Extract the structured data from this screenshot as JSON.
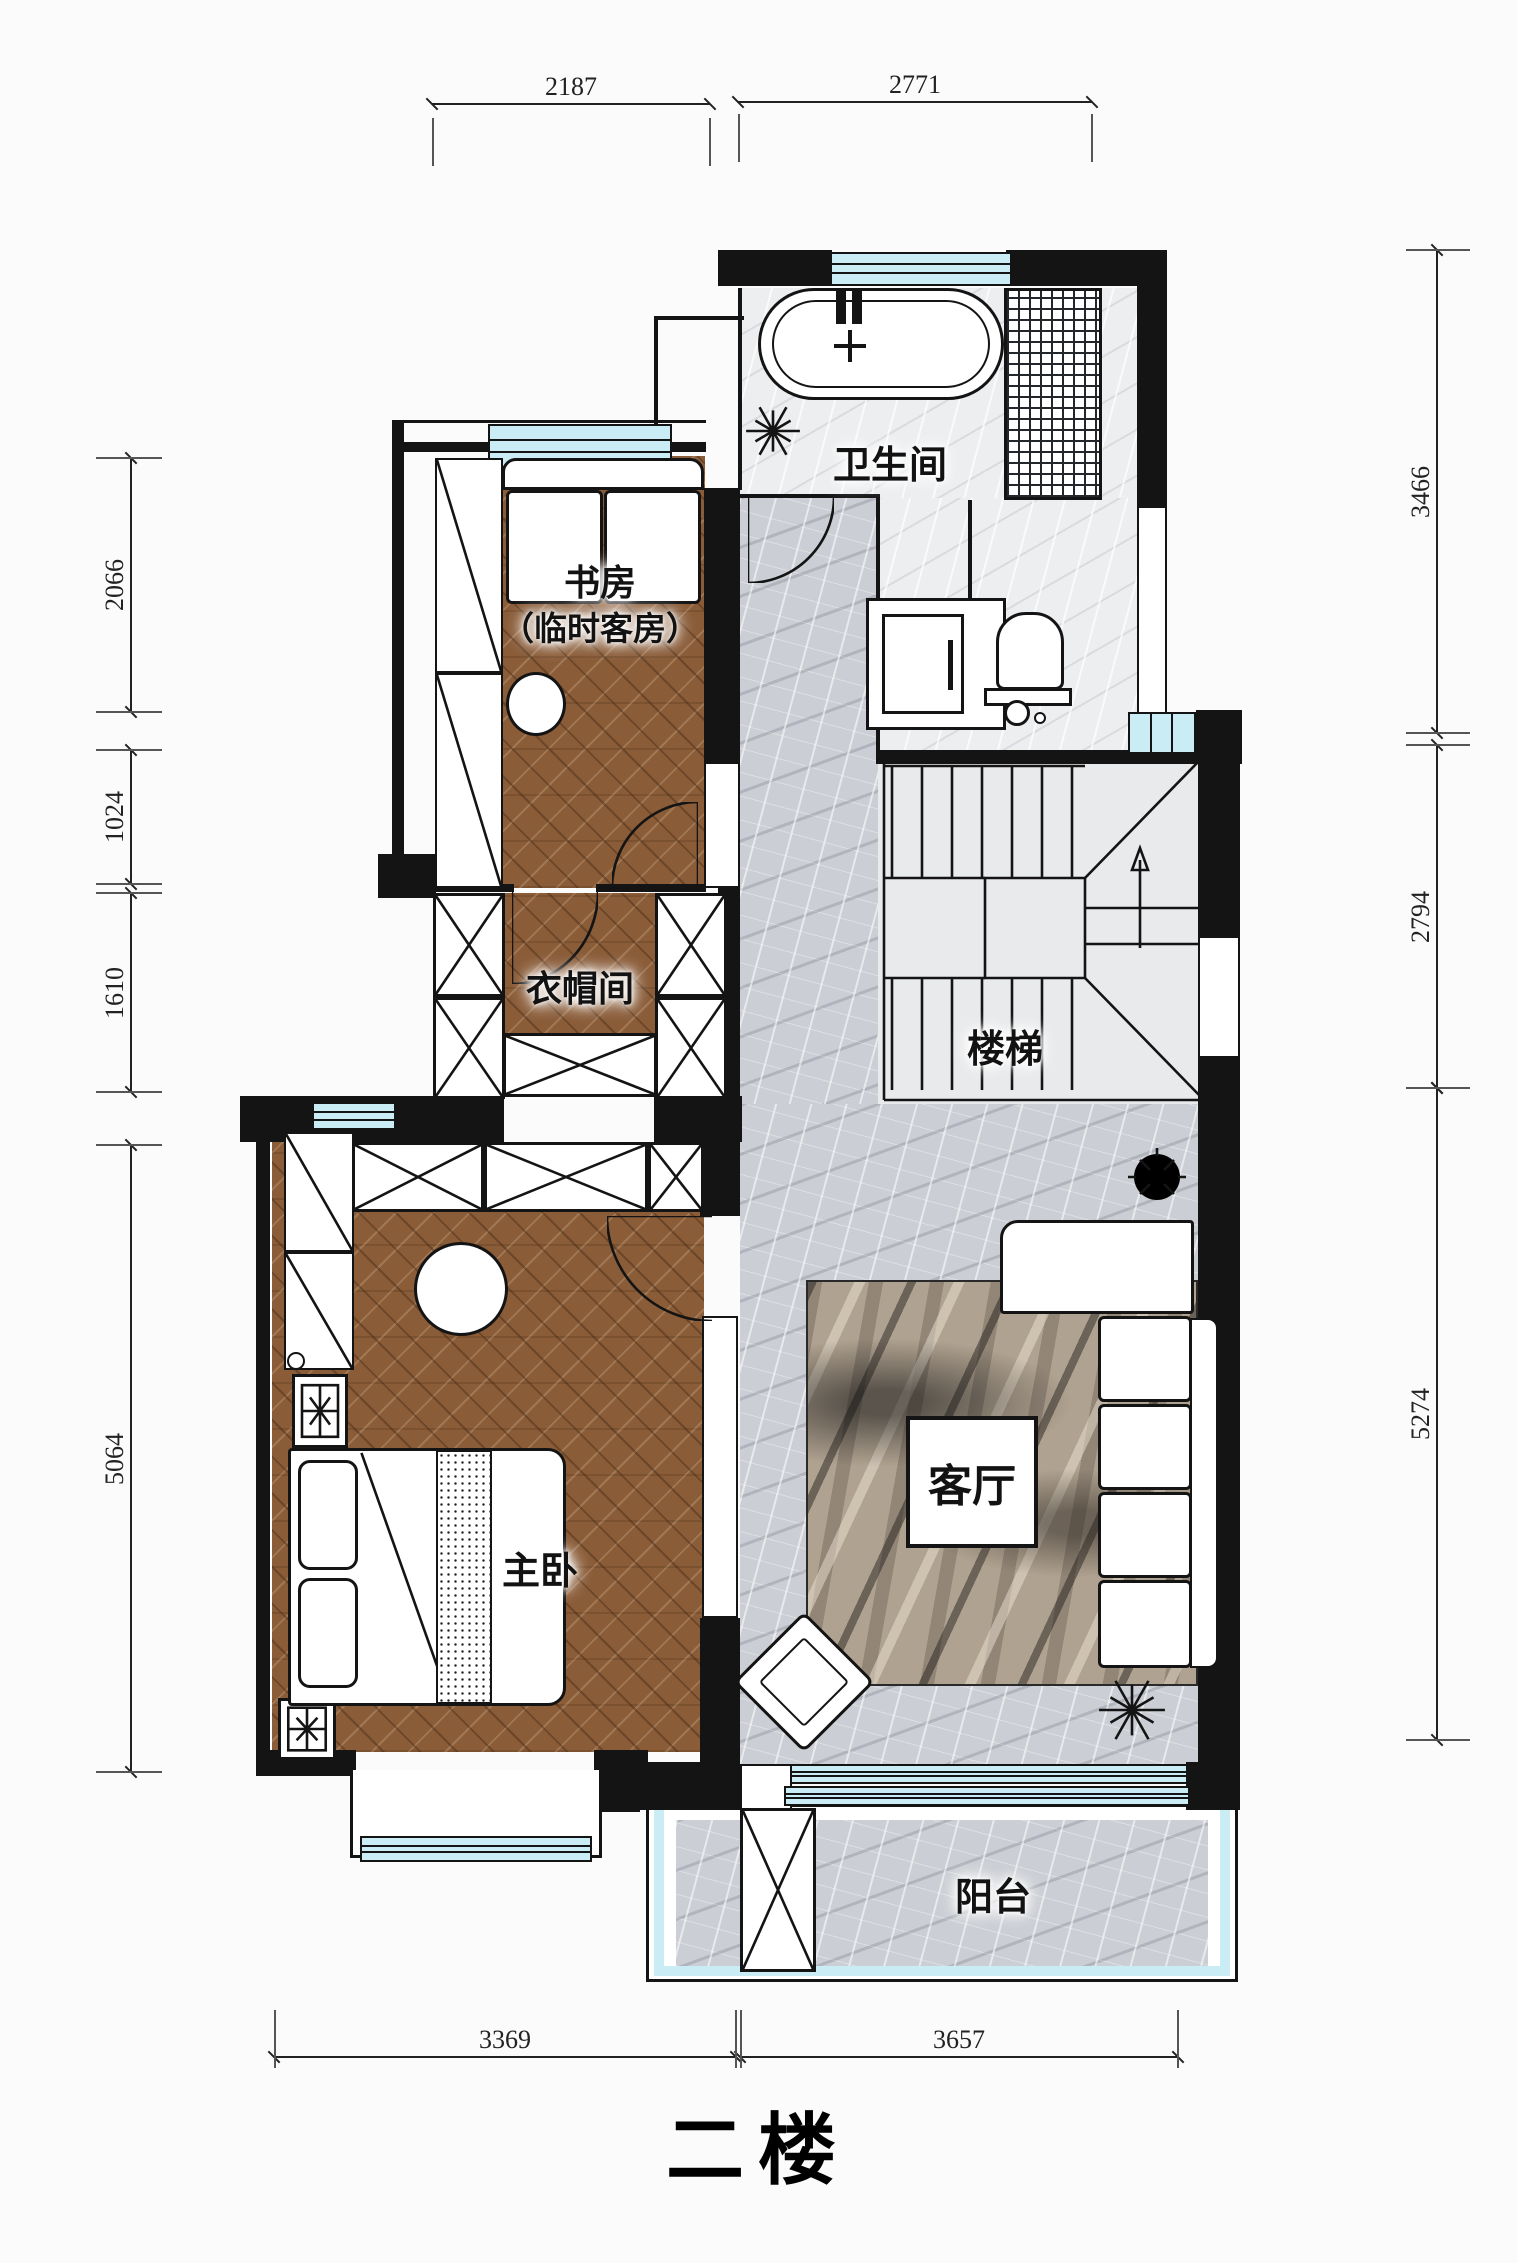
{
  "title": "二楼",
  "rooms": {
    "study1": "书房",
    "study2": "（临时客房）",
    "bathroom": "卫生间",
    "closet": "衣帽间",
    "stairs": "楼梯",
    "master": "主卧",
    "living": "客厅",
    "balcony": "阳台"
  },
  "dimensions": {
    "top": [
      "2187",
      "2771"
    ],
    "left": [
      "2066",
      "1024",
      "1610",
      "5064"
    ],
    "right": [
      "3466",
      "2794",
      "5274"
    ],
    "bottom": [
      "3369",
      "3657"
    ]
  },
  "colors": {
    "wall": "#141414",
    "window_glass": "#c9ecf5",
    "wood_floor": "#8a5c38",
    "tile_gray": "#cbced4",
    "ink": "#222222"
  }
}
